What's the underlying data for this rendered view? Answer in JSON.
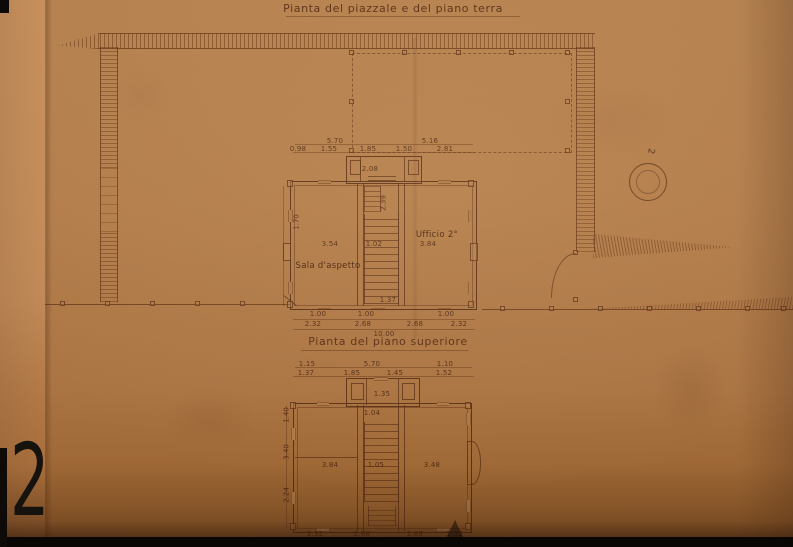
{
  "photo": {
    "backdrop_color": "#120a05",
    "paper_color": "#b27c4a",
    "ink_color": "#5c3014",
    "plate_numeral": "2"
  },
  "titles": {
    "ground": "Pianta del piazzale e del piano terra",
    "upper": "Pianta del piano superiore"
  },
  "site": {
    "well_label": "2"
  },
  "ground_floor": {
    "room_labels": {
      "waiting": "Sala d'aspetto",
      "office": "Ufficio 2°"
    },
    "dims": {
      "top_row1": [
        "5.70",
        "5.16"
      ],
      "top_row2": [
        "0.98",
        "1.55",
        "1.85",
        "1.50",
        "2.81"
      ],
      "vestibule": "2.08",
      "stair": "2.39",
      "mid_row": [
        "3.54",
        "1.02",
        "3.84"
      ],
      "wall_row": [
        "1.37",
        "1.00",
        "1.00",
        "1.00"
      ],
      "bottom_row": [
        "2.32",
        "2.68",
        "2.68",
        "2.32"
      ],
      "total": "10.00",
      "left": "1.70"
    }
  },
  "upper_floor": {
    "dims": {
      "top_row1": [
        "1.15",
        "5.70",
        "1.10"
      ],
      "top_row2": [
        "1.37",
        "1.85",
        "1.45",
        "1.52"
      ],
      "vestibule": "1.35",
      "hall": "1.04",
      "mid_row": [
        "3.84",
        "1.05",
        "3.48"
      ],
      "bottom_row": [
        "2.32",
        "2.68",
        "2.68",
        "2.32"
      ],
      "left": [
        "1.40",
        "3.40",
        "2.24"
      ]
    }
  }
}
